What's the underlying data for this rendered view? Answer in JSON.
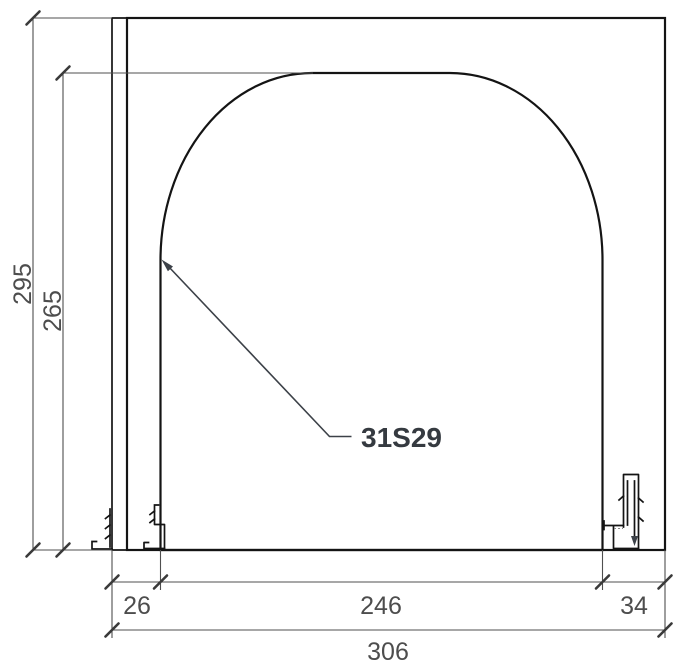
{
  "drawing": {
    "callout_label": "31S29",
    "dims": {
      "total_height": "295",
      "opening_height": "265",
      "left_jamb_width": "26",
      "opening_width": "246",
      "right_jamb_width": "34",
      "total_width": "306"
    },
    "colors": {
      "concrete-base": "#e4edf4",
      "wood-base": "#a3714d",
      "outline": "#141414",
      "dim-line": "#4f4f4f",
      "dim-text": "#4d4d4d",
      "callout-text": "#353a40"
    }
  }
}
